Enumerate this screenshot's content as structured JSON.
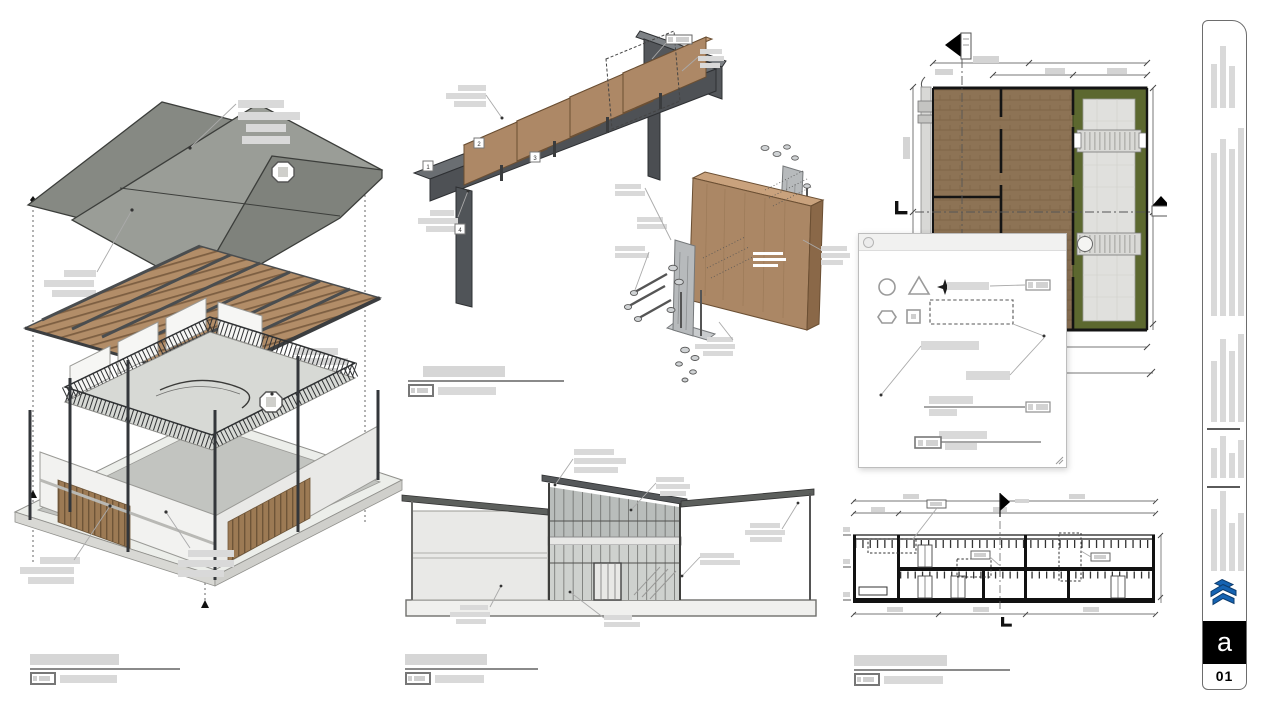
{
  "sheet": {
    "background": "#ffffff"
  },
  "colors": {
    "accent_blue": "#1563b2",
    "steel": "#53565a",
    "wood_panel": "#ad8866",
    "wood_slat": "#b28d68",
    "plan_floor": "#8d7355",
    "plan_green": "#5c682f",
    "plan_concrete": "#e0e0dd",
    "greek_text": "#d9d9d9",
    "roof_gray": "#9a9d97"
  },
  "beam_detail": {
    "callouts": [
      "1",
      "2",
      "3",
      "4"
    ]
  },
  "dialog": {
    "shape_icons": [
      "circle",
      "triangle",
      "sparkle",
      "hexagon",
      "square"
    ]
  },
  "sidebar": {
    "page_number": "01",
    "logo_letter": "a",
    "bar_groups": [
      {
        "bottom": 87,
        "heights": [
          44,
          62,
          42,
          0
        ]
      },
      {
        "bottom": 295,
        "heights": [
          163,
          177,
          167,
          188
        ]
      },
      {
        "bottom": 401,
        "heights": [
          61,
          83,
          71,
          88
        ]
      },
      {
        "bottom": 457,
        "heights": [
          30,
          42,
          25,
          38
        ]
      },
      {
        "bottom": 550,
        "heights": [
          62,
          80,
          48,
          58
        ]
      }
    ],
    "dividers": [
      407,
      465
    ]
  }
}
